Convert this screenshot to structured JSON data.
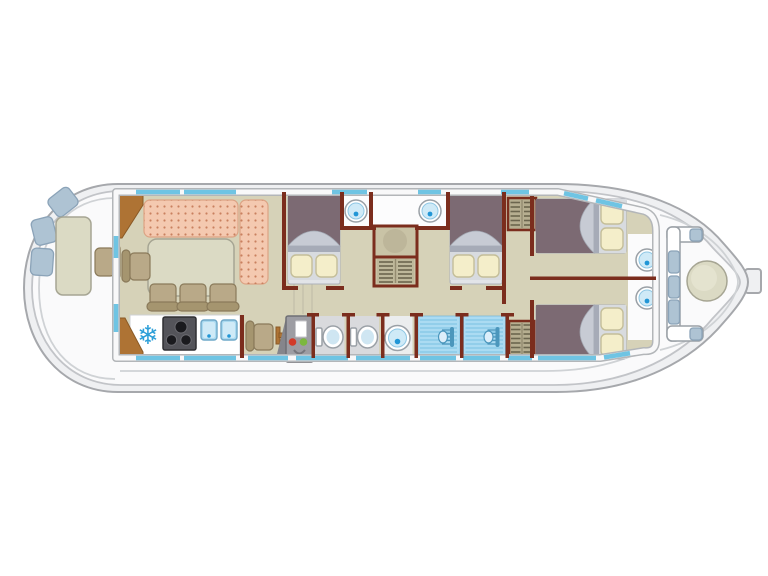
{
  "icons": {
    "snowflake_glyph": "❄"
  },
  "palette": {
    "bg": "#ffffff",
    "hullFill": "#eff0f2",
    "hullStroke": "#a6a8ac",
    "deckFill": "#fafafb",
    "deckLine": "#cfd2d5",
    "floor": "#d6d2b8",
    "wall": "#7b2d1d",
    "window": "#6fc4e3",
    "sofa": "#f4c9b0",
    "sofaDot": "#c9805f",
    "sofaStroke": "#dca384",
    "tableFill": "#dbdac4",
    "tableStroke": "#a6a593",
    "chairFill": "#b9a988",
    "chairBack": "#a5956f",
    "chairStroke": "#8a7a5a",
    "wood": "#ae7334",
    "woodStroke": "#8a5a26",
    "bedSpread": "#7c6a73",
    "bedFold": "#c7cbd4",
    "bedBand": "#a6abb7",
    "bedBase": "#e2e4e8",
    "pillow": "#f4eeca",
    "pillowStroke": "#c4be99",
    "pillowBacking": "#d8dbdf",
    "counter": "#ffffff",
    "stove": "#54545a",
    "burner": "#1a1a1e",
    "sinkSquare": "#aadaf0",
    "sinkSquareInner": "#cfeaf7",
    "snowflake": "#2d9fd8",
    "fixtureStroke": "#9aa0a6",
    "basinInner": "#cfeaf7",
    "drain": "#2196d6",
    "toiletSeat": "#cfe6f2",
    "bathFloor": "#d9dadd",
    "washFloor": "#ebedee",
    "showerFloor": "#abdbf2",
    "showerStripe": "#82c6e6",
    "showerHead": "#4b96bc",
    "wardrobe": "#b6ae90",
    "wardrobeSlat": "#6b654e",
    "wardrobeDivider": "#948c70",
    "cabinetTop": "#c9c3a6",
    "cabinetFill": "#beb89a",
    "panel": "#9d9da3",
    "panelEdge": "#6f6f75",
    "panelWedge": "#85858b",
    "lightRed": "#d23b2a",
    "lightGreen": "#7cb83f",
    "cushion": "#aec3d3",
    "cushionStroke": "#8ba3b8",
    "bandEdge": "#b3b6b9",
    "bandFill": "#f8f8f9"
  },
  "areas": {
    "plan": {
      "label": "Houseboat deck plan, side-on top view"
    },
    "stern_deck": {
      "label": "Stern deck: three seat cushions, deck table, outside steering seat"
    },
    "saloon": {
      "label": "Saloon: L-shaped sofa, dining table, four chairs"
    },
    "galley": {
      "label": "Galley: freezer, 3-burner hob, twin sinks, worktop, side chair"
    },
    "companionway": {
      "label": "Companionway steps and control panel with red and green indicators"
    },
    "cabin_mid_1": {
      "label": "Midship double cabin 1 with washbasin"
    },
    "cabin_mid_2": {
      "label": "Midship double cabin 2 with washbasin"
    },
    "central_wardrobe": {
      "label": "Central wardrobe and shelf unit"
    },
    "bathrooms": {
      "label": "Two WC rooms, washbasin room and two showers"
    },
    "wardrobes": {
      "label": "Shelved wardrobes"
    },
    "cabin_bow_1": {
      "label": "Bow double cabin 1 with washbasin"
    },
    "cabin_bow_2": {
      "label": "Bow double cabin 2 with washbasin"
    },
    "bow_deck": {
      "label": "Bow deck: bench seating with cushions and round table"
    }
  }
}
